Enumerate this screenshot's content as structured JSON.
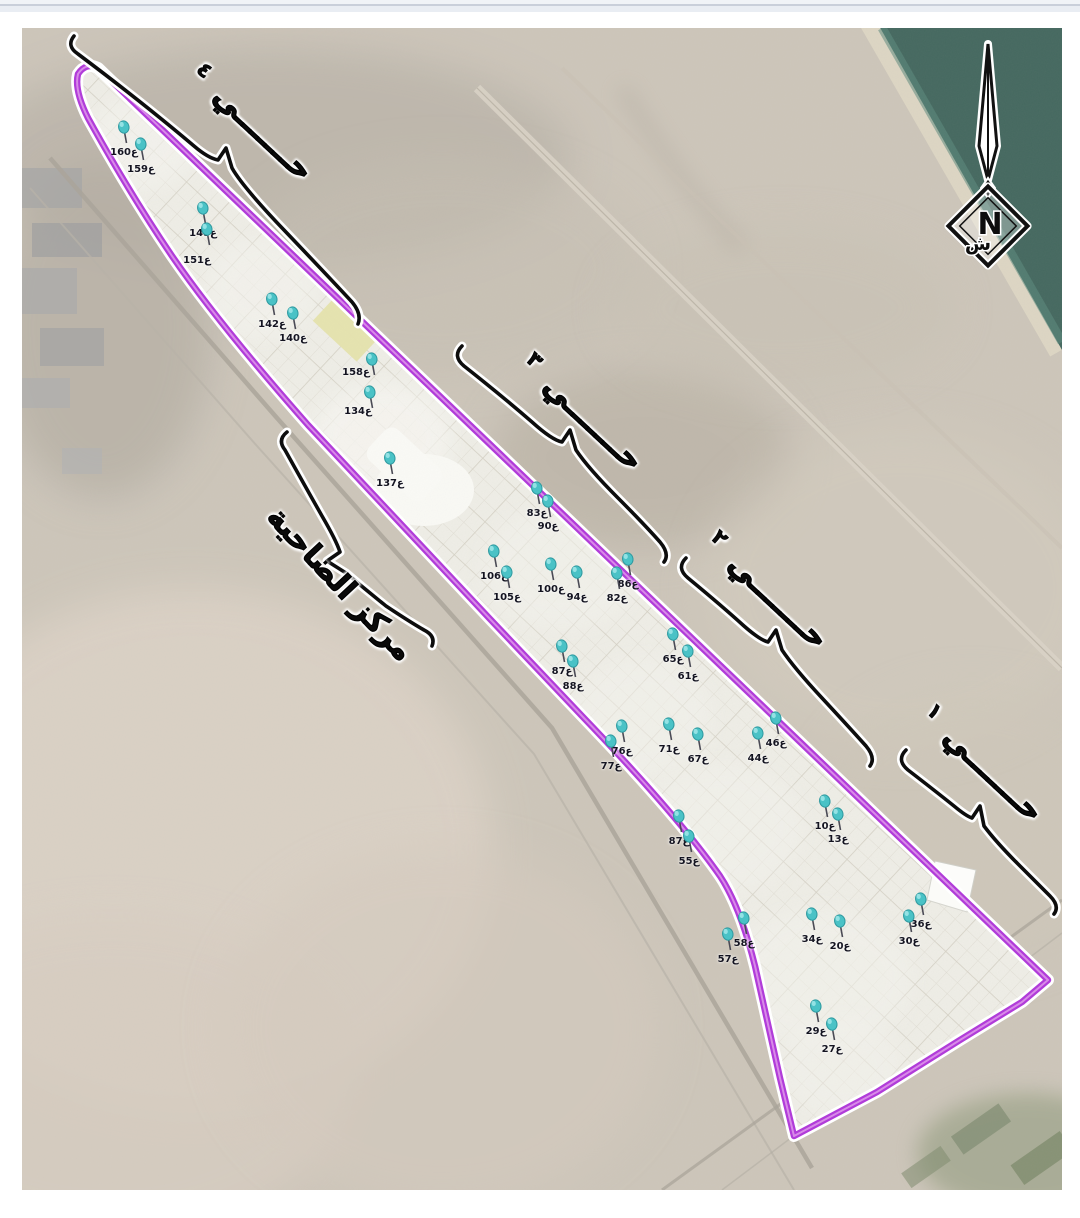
{
  "labels": {
    "district_center": "مركز الضاحية",
    "district_word": "حـــــــي",
    "districts": [
      {
        "name": "حي ١",
        "numeral": "١"
      },
      {
        "name": "حي ٢",
        "numeral": "٢"
      },
      {
        "name": "حي ٣",
        "numeral": "٣"
      },
      {
        "name": "حي ٤",
        "numeral": "٤"
      }
    ]
  },
  "compass": {
    "latin_n": "N",
    "arabic_n": "ش"
  },
  "colors": {
    "boundary": "#b13cd9",
    "boundary_core": "#d88ae8",
    "pin": "#4ac2c6",
    "pin_dark": "#2f9aa0",
    "pin_light": "#93e2e4",
    "water": "#44685f"
  },
  "pins": [
    {
      "label": "160ع",
      "x": 102,
      "y": 103
    },
    {
      "label": "159ع",
      "x": 119,
      "y": 120
    },
    {
      "label": "148ع",
      "x": 181,
      "y": 184
    },
    {
      "label": "151ع",
      "x": 185,
      "y": 205,
      "dx": -10,
      "dy": 6
    },
    {
      "label": "142ع",
      "x": 250,
      "y": 275
    },
    {
      "label": "140ع",
      "x": 271,
      "y": 289
    },
    {
      "label": "158ع",
      "x": 350,
      "y": 335,
      "dx": -16,
      "dy": -12
    },
    {
      "label": "134ع",
      "x": 348,
      "y": 368,
      "dx": -12,
      "dy": -6
    },
    {
      "label": "137ع",
      "x": 368,
      "y": 434
    },
    {
      "label": "83ع",
      "x": 515,
      "y": 464
    },
    {
      "label": "90ع",
      "x": 526,
      "y": 477
    },
    {
      "label": "106ع",
      "x": 472,
      "y": 527
    },
    {
      "label": "105ع",
      "x": 485,
      "y": 548
    },
    {
      "label": "100ع",
      "x": 529,
      "y": 540
    },
    {
      "label": "94ع",
      "x": 555,
      "y": 548
    },
    {
      "label": "86ع",
      "x": 606,
      "y": 535
    },
    {
      "label": "82ع",
      "x": 595,
      "y": 549
    },
    {
      "label": "87ع",
      "x": 540,
      "y": 622
    },
    {
      "label": "88ع",
      "x": 551,
      "y": 637
    },
    {
      "label": "65ع",
      "x": 651,
      "y": 610
    },
    {
      "label": "61ع",
      "x": 666,
      "y": 627
    },
    {
      "label": "76ع",
      "x": 600,
      "y": 702
    },
    {
      "label": "77ع",
      "x": 589,
      "y": 717
    },
    {
      "label": "71ع",
      "x": 647,
      "y": 700
    },
    {
      "label": "67ع",
      "x": 676,
      "y": 710
    },
    {
      "label": "46ع",
      "x": 754,
      "y": 694
    },
    {
      "label": "44ع",
      "x": 736,
      "y": 709
    },
    {
      "label": "87ع",
      "x": 657,
      "y": 792
    },
    {
      "label": "55ع",
      "x": 667,
      "y": 812
    },
    {
      "label": "10ع",
      "x": 803,
      "y": 777
    },
    {
      "label": "13ع",
      "x": 816,
      "y": 790
    },
    {
      "label": "36ع",
      "x": 899,
      "y": 875
    },
    {
      "label": "30ع",
      "x": 887,
      "y": 892
    },
    {
      "label": "58ع",
      "x": 722,
      "y": 894
    },
    {
      "label": "57ع",
      "x": 706,
      "y": 910
    },
    {
      "label": "34ع",
      "x": 790,
      "y": 890
    },
    {
      "label": "20ع",
      "x": 818,
      "y": 897
    },
    {
      "label": "29ع",
      "x": 794,
      "y": 982
    },
    {
      "label": "27ع",
      "x": 810,
      "y": 1000
    }
  ]
}
